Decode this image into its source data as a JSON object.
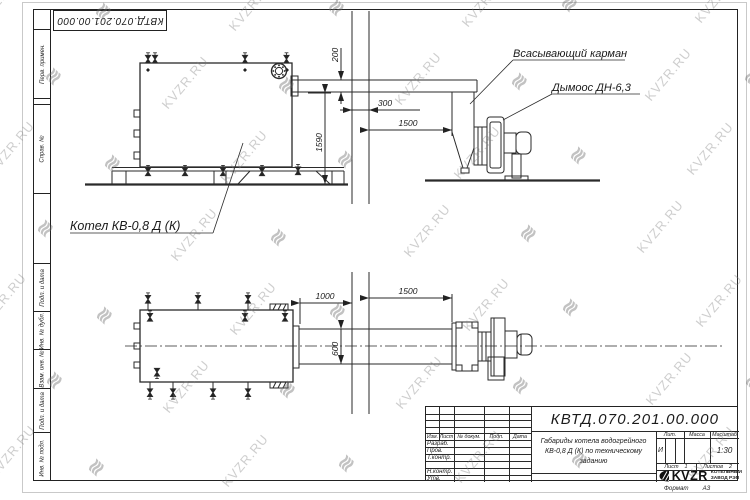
{
  "watermark": {
    "text": "KVZR.RU",
    "logo_glyph": "≋"
  },
  "stamp": {
    "doc_number": "КВТД.070.201.00.000"
  },
  "margin_labels": [
    "Перв. примен.",
    "Справ. №",
    "Подп. и дата",
    "Инв. № дубл.",
    "Взам. инв. №",
    "Подп. и дата",
    "Инв. № подл."
  ],
  "drawing": {
    "labels": {
      "suction_pocket": "Всасывающий карман",
      "fan": "Дымоос ДН-6,3",
      "boiler": "Котел КВ-0,8 Д (К)"
    },
    "dims": {
      "duct_height": "200",
      "wall_thickness": "300",
      "wall_to_fan": "1500",
      "floor_to_duct": "1590",
      "boiler_to_wall": "1000",
      "wall_to_fan_plan": "1500",
      "duct_width": "600"
    }
  },
  "title_block": {
    "doc_number": "КВТД.070.201.00.000",
    "header_cols": [
      "Изм.",
      "Лист",
      "№ докум.",
      "Подп.",
      "Дата"
    ],
    "sig_rows": [
      "Разраб.",
      "Пров.",
      "Т.контр.",
      "",
      "Н.контр.",
      "Утв."
    ],
    "description_lines": [
      "Габариды котела водогрейного",
      "КВ-0,8 Д (К) по техническому",
      "заданию"
    ],
    "lit_header": "Лит.",
    "lit_value": "И",
    "mass_header": "Масса",
    "scale_header": "Масштаб",
    "scale_value": "1:30",
    "sheet_label": "Лист",
    "sheet_value": "1",
    "sheets_label": "Листов",
    "sheets_value": "2",
    "company": {
      "logo_text": "KVZR",
      "name_line1": "КОТЕЛЬНЫЙ",
      "name_line2": "ЗАВОД РЭП"
    },
    "format_label": "Формат",
    "format_value": "А3"
  }
}
